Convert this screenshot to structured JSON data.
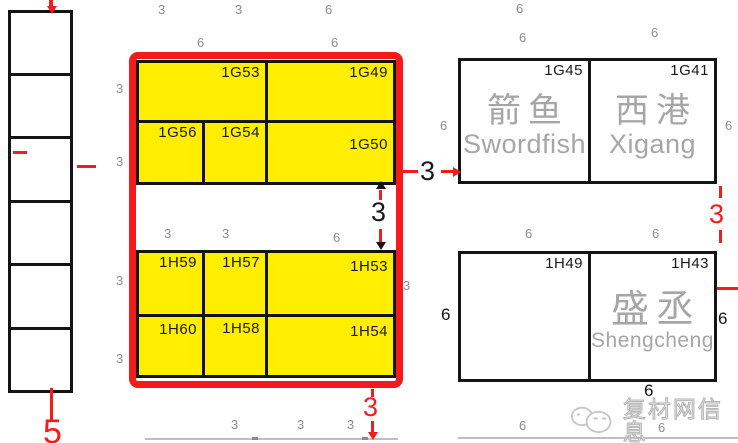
{
  "colors": {
    "yellow": "#ffee00",
    "red": "#f51b1b",
    "line": "#141414",
    "grey_dim": "#8d8d8d",
    "company_grey": "#a6a6a6",
    "lightline": "#bfbfbf",
    "tick": "#8a8a8a"
  },
  "left_column": {
    "x": 8,
    "w": 65,
    "tops": [
      10,
      73,
      136,
      200,
      263,
      327
    ],
    "heights": [
      66,
      66,
      67,
      66,
      67,
      66
    ]
  },
  "red_frame": {
    "x": 129,
    "y": 52,
    "w": 274,
    "h": 336
  },
  "booths": [
    {
      "id": "1G53",
      "x": 136,
      "y": 60,
      "w": 132,
      "h": 63,
      "fill": "yellow"
    },
    {
      "id": "1G49",
      "x": 265,
      "y": 60,
      "w": 131,
      "h": 63,
      "fill": "yellow"
    },
    {
      "id": "1G56",
      "x": 136,
      "y": 120,
      "w": 69,
      "h": 65,
      "fill": "yellow"
    },
    {
      "id": "1G54",
      "x": 202,
      "y": 120,
      "w": 66,
      "h": 65,
      "fill": "yellow"
    },
    {
      "id": "1G50",
      "x": 265,
      "y": 120,
      "w": 131,
      "h": 65,
      "fill": "yellow",
      "lpad": 14
    },
    {
      "id": "1H59",
      "x": 136,
      "y": 250,
      "w": 69,
      "h": 67,
      "fill": "yellow"
    },
    {
      "id": "1H57",
      "x": 202,
      "y": 250,
      "w": 66,
      "h": 67,
      "fill": "yellow"
    },
    {
      "id": "1H53",
      "x": 265,
      "y": 250,
      "w": 131,
      "h": 67,
      "fill": "yellow",
      "lpad": 6
    },
    {
      "id": "1H60",
      "x": 136,
      "y": 314,
      "w": 69,
      "h": 64,
      "fill": "yellow",
      "lpad": 5
    },
    {
      "id": "1H58",
      "x": 202,
      "y": 314,
      "w": 66,
      "h": 64,
      "fill": "yellow",
      "lpad": 4
    },
    {
      "id": "1H54",
      "x": 265,
      "y": 314,
      "w": 131,
      "h": 64,
      "fill": "yellow",
      "lpad": 7
    },
    {
      "id": "1G45",
      "x": 458,
      "y": 58,
      "w": 133,
      "h": 126,
      "fill": "white",
      "company": {
        "zh": "箭鱼",
        "en": "Swordfish",
        "zh_size": 34,
        "en_size": 27
      }
    },
    {
      "id": "1G41",
      "x": 588,
      "y": 58,
      "w": 129,
      "h": 126,
      "fill": "white",
      "company": {
        "zh": "西港",
        "en": "Xigang",
        "zh_size": 34,
        "en_size": 27
      }
    },
    {
      "id": "1H49",
      "x": 458,
      "y": 251,
      "w": 133,
      "h": 131,
      "fill": "white"
    },
    {
      "id": "1H43",
      "x": 588,
      "y": 251,
      "w": 129,
      "h": 131,
      "fill": "white",
      "company": {
        "zh": "盛丞",
        "en": "Shengcheng",
        "zh_size": 38,
        "en_size": 21
      }
    }
  ],
  "dim_labels": [
    {
      "t": "3",
      "x": 158,
      "y": 3,
      "cls": "g"
    },
    {
      "t": "3",
      "x": 235,
      "y": 3,
      "cls": "g"
    },
    {
      "t": "6",
      "x": 325,
      "y": 3,
      "cls": "g"
    },
    {
      "t": "6",
      "x": 516,
      "y": 2,
      "cls": "g"
    },
    {
      "t": "6",
      "x": 197,
      "y": 36,
      "cls": "g"
    },
    {
      "t": "6",
      "x": 331,
      "y": 36,
      "cls": "g"
    },
    {
      "t": "6",
      "x": 519,
      "y": 31,
      "cls": "g"
    },
    {
      "t": "6",
      "x": 651,
      "y": 26,
      "cls": "g"
    },
    {
      "t": "3",
      "x": 116,
      "y": 82,
      "cls": "g"
    },
    {
      "t": "3",
      "x": 116,
      "y": 155,
      "cls": "g"
    },
    {
      "t": "3",
      "x": 116,
      "y": 274,
      "cls": "g"
    },
    {
      "t": "3",
      "x": 116,
      "y": 352,
      "cls": "g"
    },
    {
      "t": "3",
      "x": 164,
      "y": 227,
      "cls": "g"
    },
    {
      "t": "3",
      "x": 222,
      "y": 227,
      "cls": "g"
    },
    {
      "t": "6",
      "x": 333,
      "y": 231,
      "cls": "g"
    },
    {
      "t": "3",
      "x": 403,
      "y": 279,
      "cls": "g"
    },
    {
      "t": "6",
      "x": 440,
      "y": 119,
      "cls": "g"
    },
    {
      "t": "6",
      "x": 725,
      "y": 119,
      "cls": "g"
    },
    {
      "t": "6",
      "x": 525,
      "y": 227,
      "cls": "g"
    },
    {
      "t": "6",
      "x": 652,
      "y": 227,
      "cls": "g"
    },
    {
      "t": "3",
      "x": 231,
      "y": 418,
      "cls": "g"
    },
    {
      "t": "3",
      "x": 297,
      "y": 418,
      "cls": "g"
    },
    {
      "t": "3",
      "x": 347,
      "y": 418,
      "cls": "g"
    },
    {
      "t": "6",
      "x": 519,
      "y": 419,
      "cls": "g"
    },
    {
      "t": "6",
      "x": 658,
      "y": 421,
      "cls": "g"
    },
    {
      "t": "6",
      "x": 441,
      "y": 306,
      "cls": "k"
    },
    {
      "t": "6",
      "x": 718,
      "y": 310,
      "cls": "k"
    },
    {
      "t": "6",
      "x": 644,
      "y": 382,
      "cls": "k"
    },
    {
      "t": "3",
      "x": 420,
      "y": 158,
      "cls": "B"
    },
    {
      "t": "3",
      "x": 371,
      "y": 199,
      "cls": "B"
    },
    {
      "t": "3",
      "x": 363,
      "y": 394,
      "cls": "R"
    },
    {
      "t": "3",
      "x": 709,
      "y": 201,
      "cls": "R"
    },
    {
      "t": "5",
      "x": 43,
      "y": 415,
      "cls": "R5"
    }
  ],
  "marks": [
    {
      "x": 49,
      "y": 0,
      "w": 4,
      "h": 8,
      "c": "red"
    },
    {
      "x": 13,
      "y": 151,
      "w": 14,
      "h": 3,
      "c": "red"
    },
    {
      "x": 77,
      "y": 165,
      "w": 19,
      "h": 3,
      "c": "red"
    },
    {
      "x": 50,
      "y": 388,
      "w": 3,
      "h": 33,
      "c": "red"
    },
    {
      "x": 403,
      "y": 170,
      "w": 15,
      "h": 3,
      "c": "red"
    },
    {
      "x": 441,
      "y": 170,
      "w": 13,
      "h": 3,
      "c": "red"
    },
    {
      "x": 379,
      "y": 190,
      "w": 3,
      "h": 10,
      "c": "red"
    },
    {
      "x": 379,
      "y": 229,
      "w": 3,
      "h": 13,
      "c": "red"
    },
    {
      "x": 371,
      "y": 389,
      "w": 3,
      "h": 8,
      "c": "red"
    },
    {
      "x": 371,
      "y": 421,
      "w": 3,
      "h": 13,
      "c": "red"
    },
    {
      "x": 719,
      "y": 186,
      "w": 3,
      "h": 12,
      "c": "red"
    },
    {
      "x": 719,
      "y": 230,
      "w": 3,
      "h": 13,
      "c": "red"
    },
    {
      "x": 717,
      "y": 287,
      "w": 21,
      "h": 3,
      "c": "red"
    },
    {
      "x": 145,
      "y": 438,
      "w": 253,
      "h": 2,
      "c": "lightline"
    },
    {
      "x": 458,
      "y": 437,
      "w": 280,
      "h": 2,
      "c": "lightline"
    },
    {
      "x": 252,
      "y": 437,
      "w": 6,
      "h": 3,
      "c": "tick"
    },
    {
      "x": 362,
      "y": 437,
      "w": 6,
      "h": 3,
      "c": "tick"
    }
  ],
  "arrows": [
    {
      "x": 453,
      "y": 167,
      "dir": "right",
      "c": "#f51b1b"
    },
    {
      "x": 376,
      "y": 181,
      "dir": "up",
      "c": "#141414"
    },
    {
      "x": 376,
      "y": 242,
      "dir": "down",
      "c": "#141414"
    },
    {
      "x": 368,
      "y": 432,
      "dir": "down",
      "c": "#f51b1b"
    },
    {
      "x": 47,
      "y": 6,
      "dir": "down",
      "c": "#f51b1b"
    }
  ],
  "watermark": {
    "text": "复材网信息"
  }
}
